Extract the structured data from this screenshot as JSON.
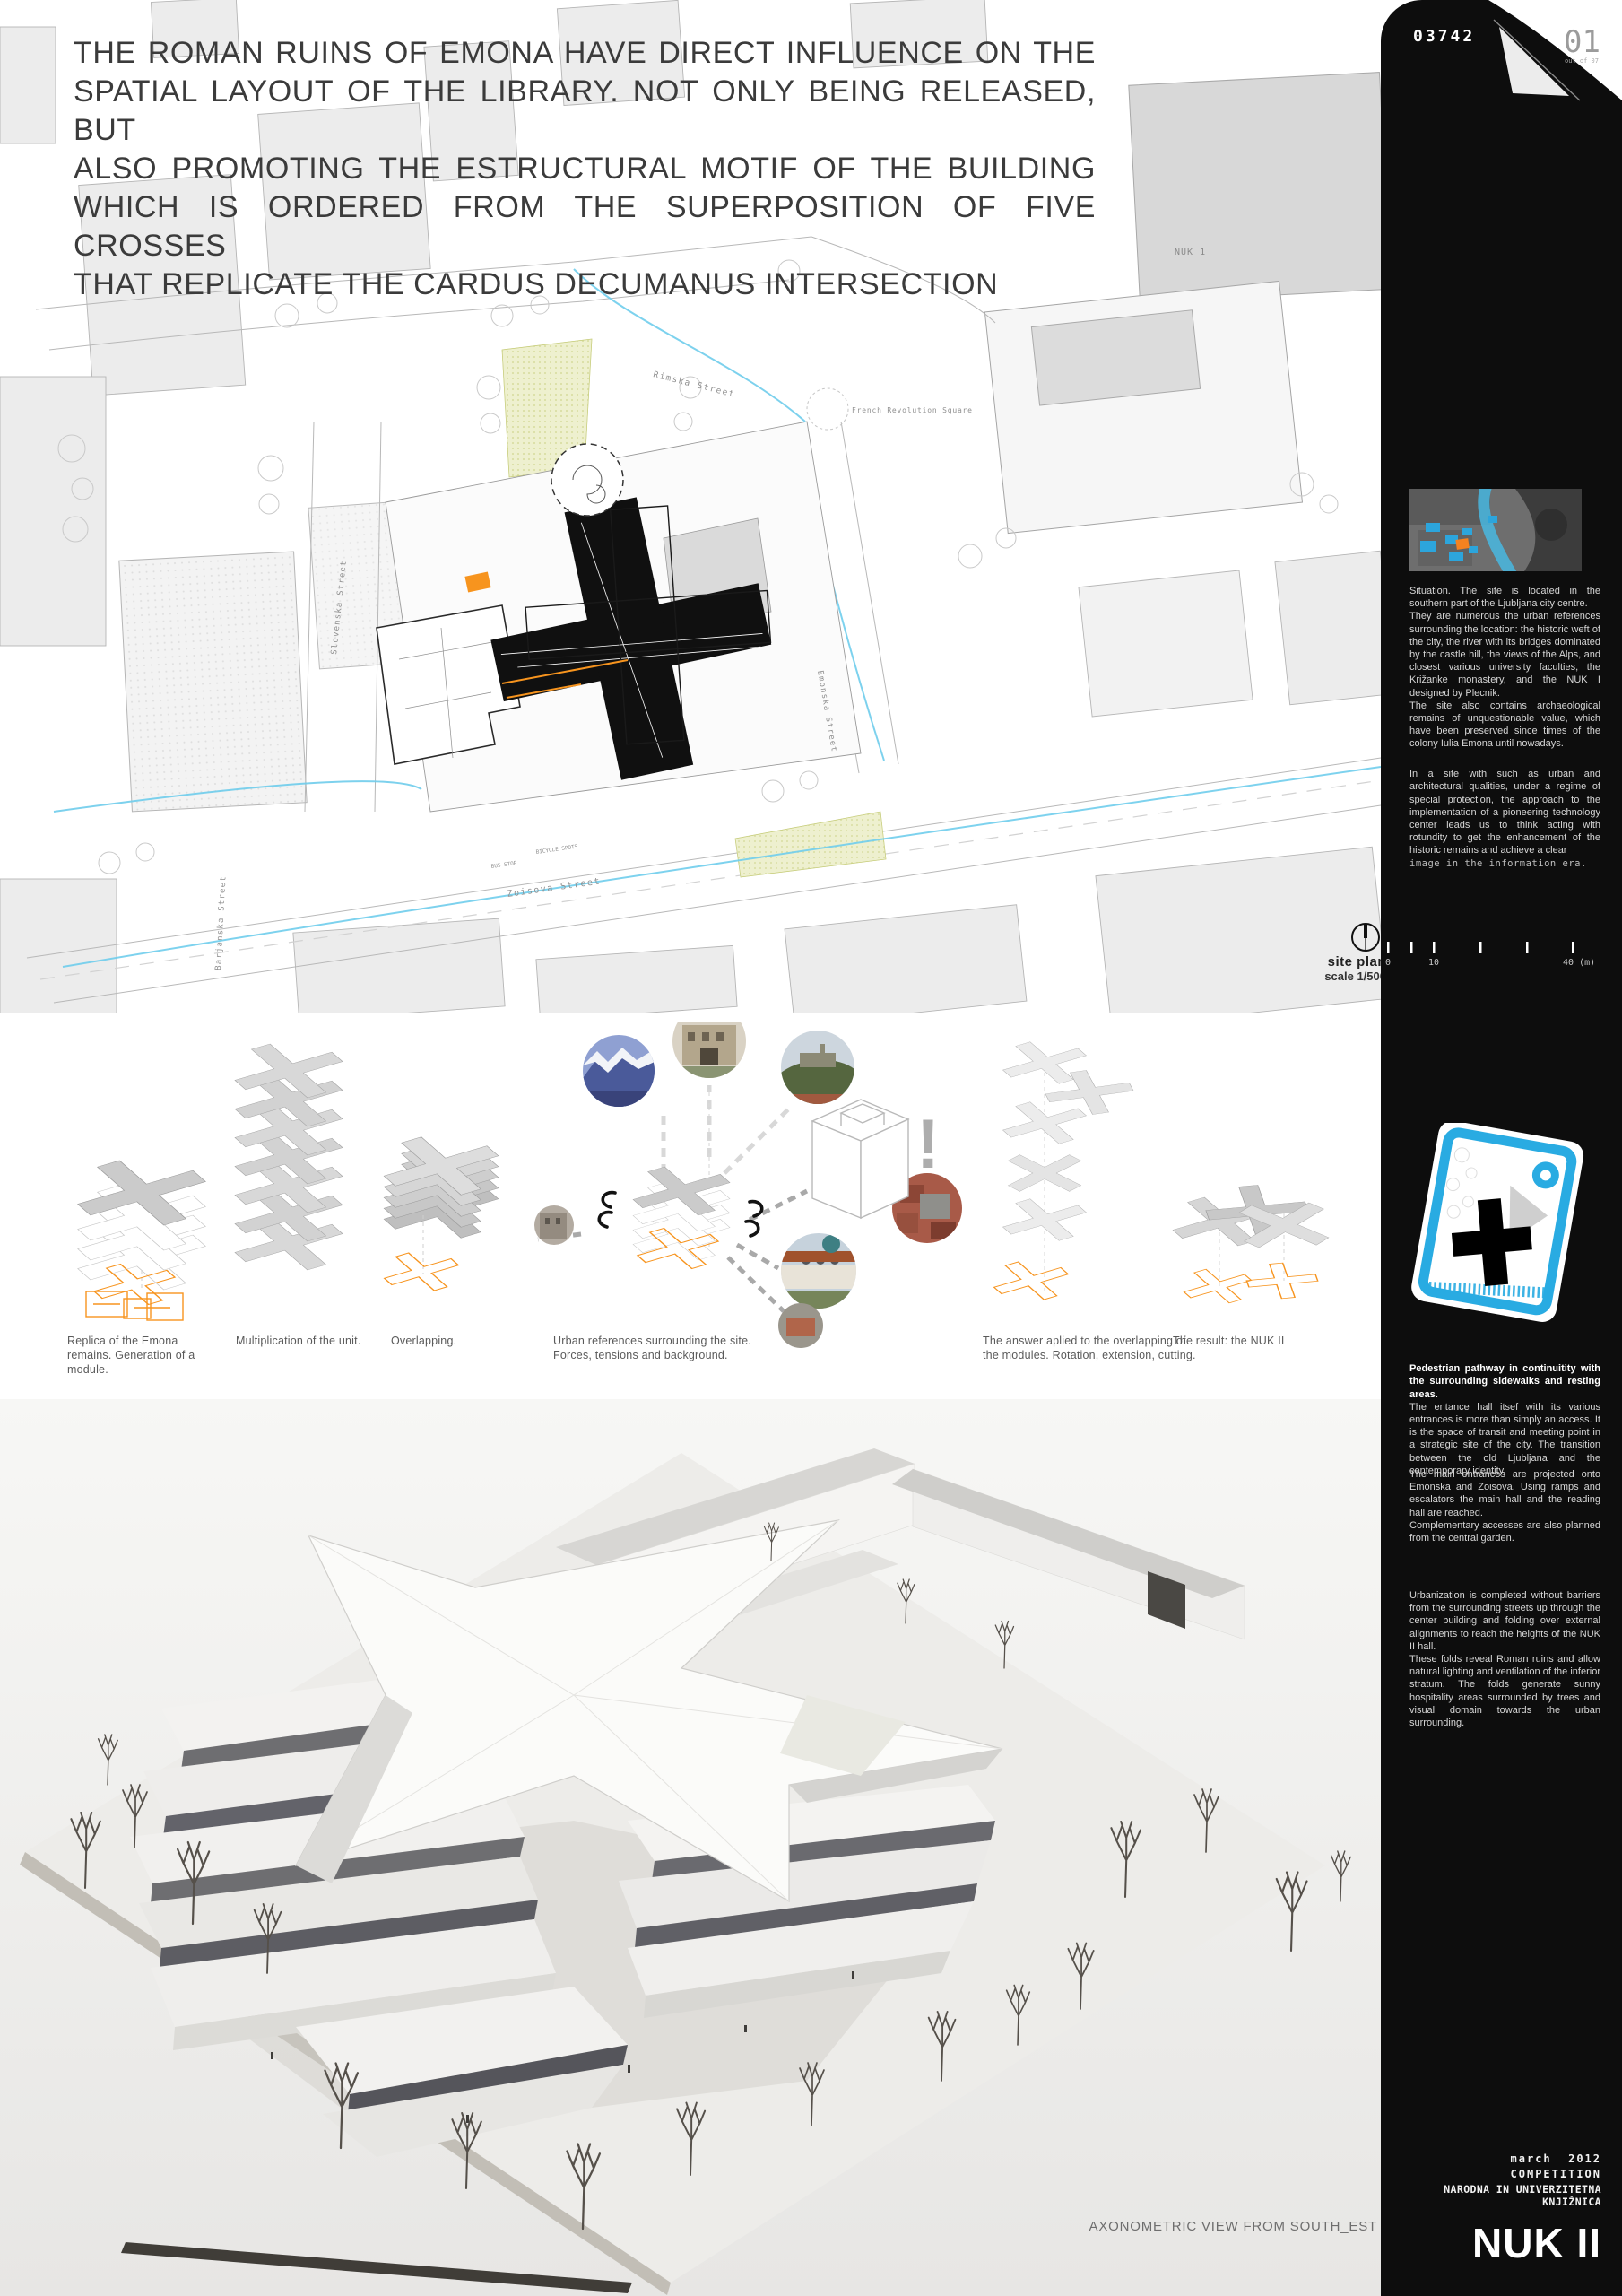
{
  "page": {
    "board_number": "03742",
    "page_number": "01",
    "page_count_note": "out of 07"
  },
  "statement": {
    "lines": [
      "THE ROMAN RUINS OF EMONA HAVE DIRECT INFLUENCE ON THE",
      "SPATIAL LAYOUT OF THE LIBRARY. NOT ONLY BEING RELEASED, BUT",
      "ALSO PROMOTING THE ESTRUCTURAL MOTIF OF THE BUILDING",
      "WHICH IS ORDERED FROM THE SUPERPOSITION OF FIVE CROSSES",
      "THAT REPLICATE THE CARDUS DECUMANUS INTERSECTION"
    ]
  },
  "site_plan": {
    "label": "site plan",
    "scale": "scale 1/500",
    "labels": {
      "rimska": "Rimska Street",
      "french_square": "French Revolution Square",
      "slovenska": "Slovenska Street",
      "emonska": "Emonska Street",
      "zoisova": "Zoisova Street",
      "barjanska": "Barjanska Street",
      "nuk1": "NUK 1",
      "bus_stop": "BUS STOP",
      "bicycle": "BICYCLE SPOTS"
    },
    "scalebar_ticks": [
      "0",
      "10",
      "40 (m)"
    ]
  },
  "concept": {
    "exclamation": "!",
    "captions": [
      "Replica of the Emona remains. Generation of a module.",
      "Multiplication of the unit.",
      "Overlapping.",
      "Urban references surrounding the site. Forces, tensions and background.",
      "The answer aplied to the overlapping of the modules. Rotation, extension, cutting.",
      "The result: the NUK II"
    ]
  },
  "sidebar": {
    "situation_text": "Situation. The site is located in the southern part of the Ljubljana city centre.\nThey are numerous the urban references surrounding the location: the historic weft of the city, the river with its bridges dominated by the castle hill, the views of the Alps, and closest various university faculties, the Križanke monastery, and the NUK I designed by Plecnik.\nThe site also contains archaeological remains of unquestionable value, which have been preserved since times of the colony Iulia Emona until nowadays.",
    "approach_text": "In a site with such as urban and architectural qualities, under a regime of special protection, the approach to the implementation of a pioneering technology center leads us to think acting with rotundity to get the enhancement of the historic remains and achieve a clear",
    "approach_text_mono": "image in the information era.",
    "pathway_heading": "Pedestrian pathway in continuitity with the surrounding sidewalks and resting areas.",
    "pathway_text": "The entance hall itsef with its various entrances is more than simply an access. It is the space of transit and meeting point in a strategic site of the city. The transition between the old Ljubljana and the contemporary identity.",
    "entrances_text": "The main entrances are projected onto Emonska and Zoisova. Using ramps and escalators the main hall and the reading hall are reached.\nComplementary accesses are also planned from the central garden.",
    "urbanization_text": "Urbanization is completed without barriers from the surrounding streets up through the center building and folding over external alignments to reach the heights of the NUK II hall.\nThese folds reveal Roman ruins and allow natural lighting and ventilation of the inferior stratum. The folds generate sunny hospitality areas surrounded by trees and visual domain towards the urban surrounding.",
    "footer": {
      "date": "march  2012",
      "competition": "COMPETITION",
      "client": "NARODNA IN UNIVERZITETNA KNJIŽNICA",
      "project": "NUK II"
    }
  },
  "model": {
    "caption": "AXONOMETRIC VIEW FROM SOUTH_EST"
  },
  "colors": {
    "accent_blue": "#29ABE2",
    "accent_orange": "#F7941E",
    "sidebar_black": "#0d0d0d"
  }
}
